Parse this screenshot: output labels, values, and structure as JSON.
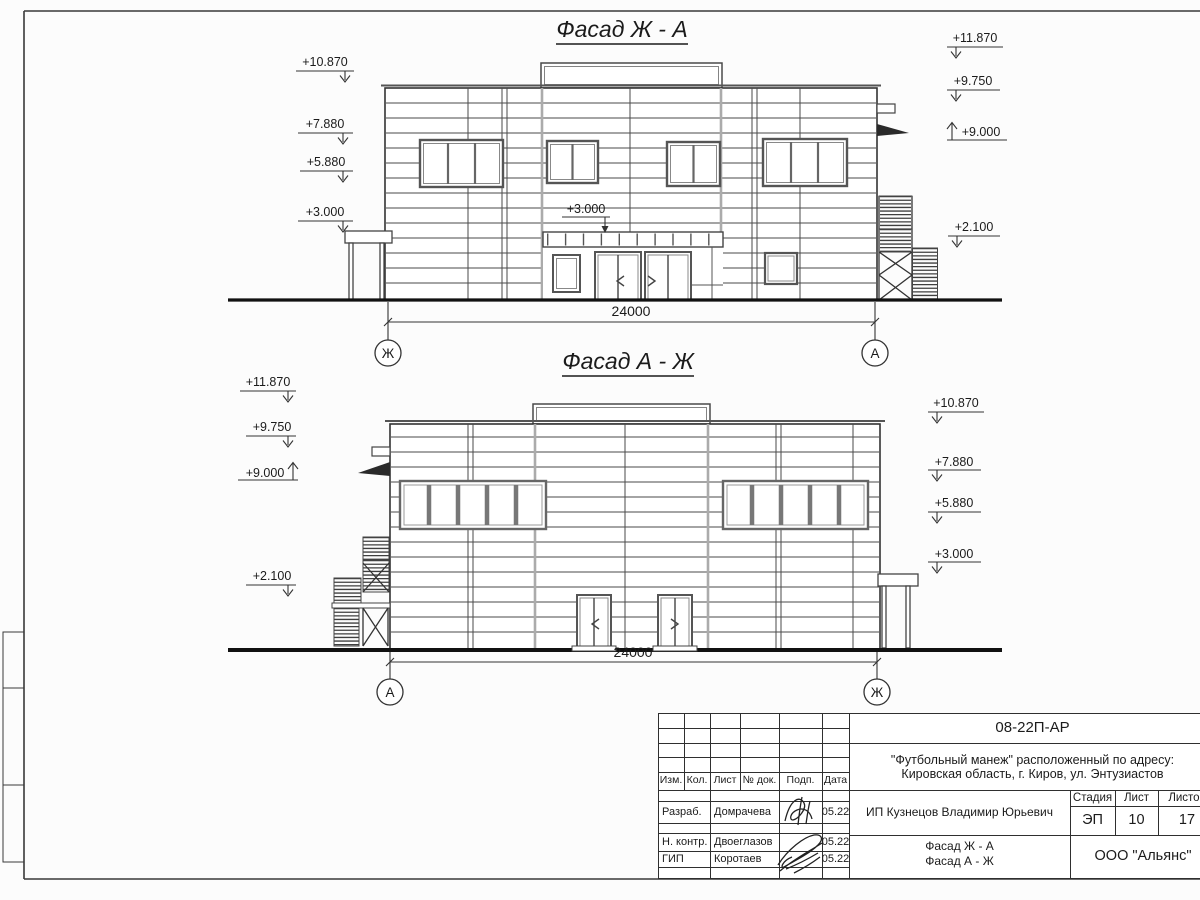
{
  "sheet": {
    "facades": [
      {
        "title": "Фасад Ж - А",
        "dimension": "24000",
        "axis_left": "Ж",
        "axis_right": "А",
        "marks_left": [
          "+10.870",
          "+7.880",
          "+5.880",
          "+3.000"
        ],
        "marks_right": [
          "+11.870",
          "+9.750",
          "+9.000",
          "+2.100"
        ],
        "mark_mid": "+3.000"
      },
      {
        "title": "Фасад А - Ж",
        "dimension": "24000",
        "axis_left": "А",
        "axis_right": "Ж",
        "marks_left": [
          "+11.870",
          "+9.750",
          "+9.000",
          "+2.100"
        ],
        "marks_right": [
          "+10.870",
          "+7.880",
          "+5.880",
          "+3.000"
        ]
      }
    ],
    "title_block": {
      "doc_number": "08-22П-АР",
      "project_line1": "\"Футбольный манеж\" расположенный по адресу:",
      "project_line2": "Кировская область, г. Киров, ул. Энтузиастов",
      "columns": [
        "Изм.",
        "Кол.",
        "Лист",
        "№ док.",
        "Подп.",
        "Дата"
      ],
      "rows": [
        {
          "role": "Разраб.",
          "name": "Домрачева",
          "date": "05.22"
        },
        {
          "role": "Н. контр.",
          "name": "Двоеглазов",
          "date": "05.22"
        },
        {
          "role": "ГИП",
          "name": "Коротаев",
          "date": "05.22"
        }
      ],
      "client": "ИП Кузнецов Владимир Юрьевич",
      "stage_label": "Стадия",
      "sheet_label": "Лист",
      "sheets_label": "Листов",
      "stage": "ЭП",
      "sheet_no": "10",
      "sheets_total": "17",
      "drawing_title_line1": "Фасад Ж - А",
      "drawing_title_line2": "Фасад А - Ж",
      "company": "ООО \"Альянс\""
    }
  }
}
